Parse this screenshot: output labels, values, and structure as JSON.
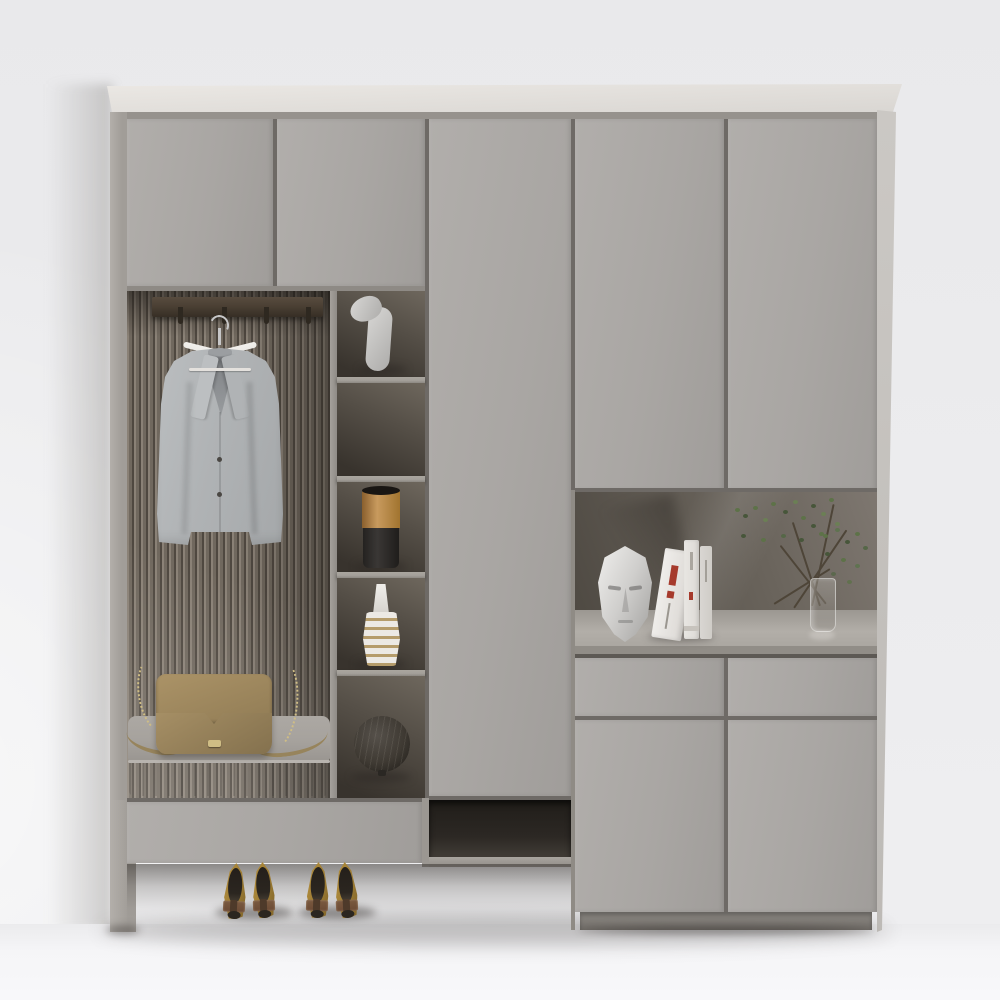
{
  "scene": {
    "description": "3D product render of a modern grey hallway wardrobe cabinet with an open hanging nook, display shelving and staged decor",
    "setting": "light grey studio wall and floor, soft daylight from the lower left",
    "label": "grey entryway wardrobe cabinet render"
  },
  "cabinet": {
    "label": "grey entryway wardrobe cabinet",
    "top_panel": "off-white top board",
    "upper_doors_left": 2,
    "tall_center_door": 1,
    "upper_doors_right": 2,
    "bottom_drawer_left": 1,
    "open_shoe_slot": "dark open compartment under centre door",
    "drawers_right": 2,
    "lower_doors_right": 2,
    "plinth": "recessed base under right section",
    "legs": "left section raised on side panel legs"
  },
  "hanging_nook": {
    "back_panel": "vertical wood slat panel",
    "rail": "dark walnut coat rail with four hooks",
    "hanger": "white wooden hanger with steel hook",
    "garment": "light grey suit jacket with two buttons",
    "bench": "grey upholstered seat cushion with pleated front",
    "bag": "tan leather crossbody bag with golden chain strap and clasp"
  },
  "shelf_tower": {
    "shelves": [
      "white abstract figure sculpture",
      "empty shelf",
      "cylindrical vase with brass top and black base",
      "white ribbed bottle vase with brass grooves",
      "dark woven rattan sphere"
    ]
  },
  "display_niche": {
    "items": [
      "white low-poly face sculpture",
      "leaning white book with red spine accents",
      "two upright white books",
      "leafy branch arrangement in a clear glass vase"
    ]
  },
  "floor_items": {
    "shoes": "two pairs of tan pointed-toe pumps with brown embellished bows"
  },
  "colors": {
    "wall": "#e9e9eb",
    "wall2": "#ededef",
    "wall3": "#efeff1",
    "floor": "#f5f5f7",
    "floorHi": "#f8f8fa",
    "topPanel": "#ebe8e4",
    "topPanelLo": "#d9d6d2",
    "sidePanel": "#cbc8c4",
    "frame": "#a19d98",
    "frameHi": "#b3afaa",
    "door": "#a9a6a3",
    "doorHi": "#b1aeab",
    "doorLo": "#a09d9a",
    "gap": "#6e6a66",
    "divider": "#9b9792",
    "shelfBoard": "#a39f99",
    "cellHi": "#6e675d",
    "cellLo": "#38332d",
    "slatHi": "#8a8176",
    "slatMid": "#70685e",
    "slatDark": "#4f4840",
    "rail": "#4b4034",
    "railLo": "#362e25",
    "hook": "#2e2820",
    "hangerWood": "#eceae6",
    "hookMetal": "#c7c7c8",
    "jacketHi": "#bcbfc1",
    "jacket": "#b0b3b5",
    "jacketLo": "#a4a7a9",
    "vneck": "#84878a",
    "cushionTop": "#a6a29d",
    "cushionFront": "#8f8b86",
    "piping": "#b8b4af",
    "bag": "#a58e63",
    "bagHi": "#b29a6e",
    "bagLo": "#84714e",
    "chain": "#cfbd85",
    "strap": "#97845c",
    "slotHi": "#413c36",
    "slot": "#201d19",
    "counter": "#b2aea8",
    "counterLo": "#918d87",
    "nicheHi": "#7e7770",
    "nicheLo": "#4f4a43",
    "mask": "#e2e1df",
    "maskLo": "#abaaa8",
    "book": "#e8e6e2",
    "book2": "#d9d6d2",
    "bookAccent": "#a63a2c",
    "branch": "#4e4538",
    "leaf": "#5d7248",
    "leafDark": "#47563a",
    "glass": "rgba(215,213,209,0.28)",
    "glassEdge": "rgba(240,240,238,0.55)",
    "sculpture": "#d8d7d5",
    "sculptureLo": "#adacaa",
    "vaseGold": "#c89a5e",
    "vaseGoldLo": "#8a5f2d",
    "vaseBlack": "#2b2826",
    "spiralWhite": "#ece9e4",
    "spiralGold": "#b59c6b",
    "sphere": "#3f3a33",
    "sphereLo": "#211e1a",
    "shoe": "#b8923f",
    "shoeLo": "#7e6228",
    "shoeBow": "#6b4a35",
    "shoeDark": "#2b2620",
    "plinth": "#827e79"
  }
}
